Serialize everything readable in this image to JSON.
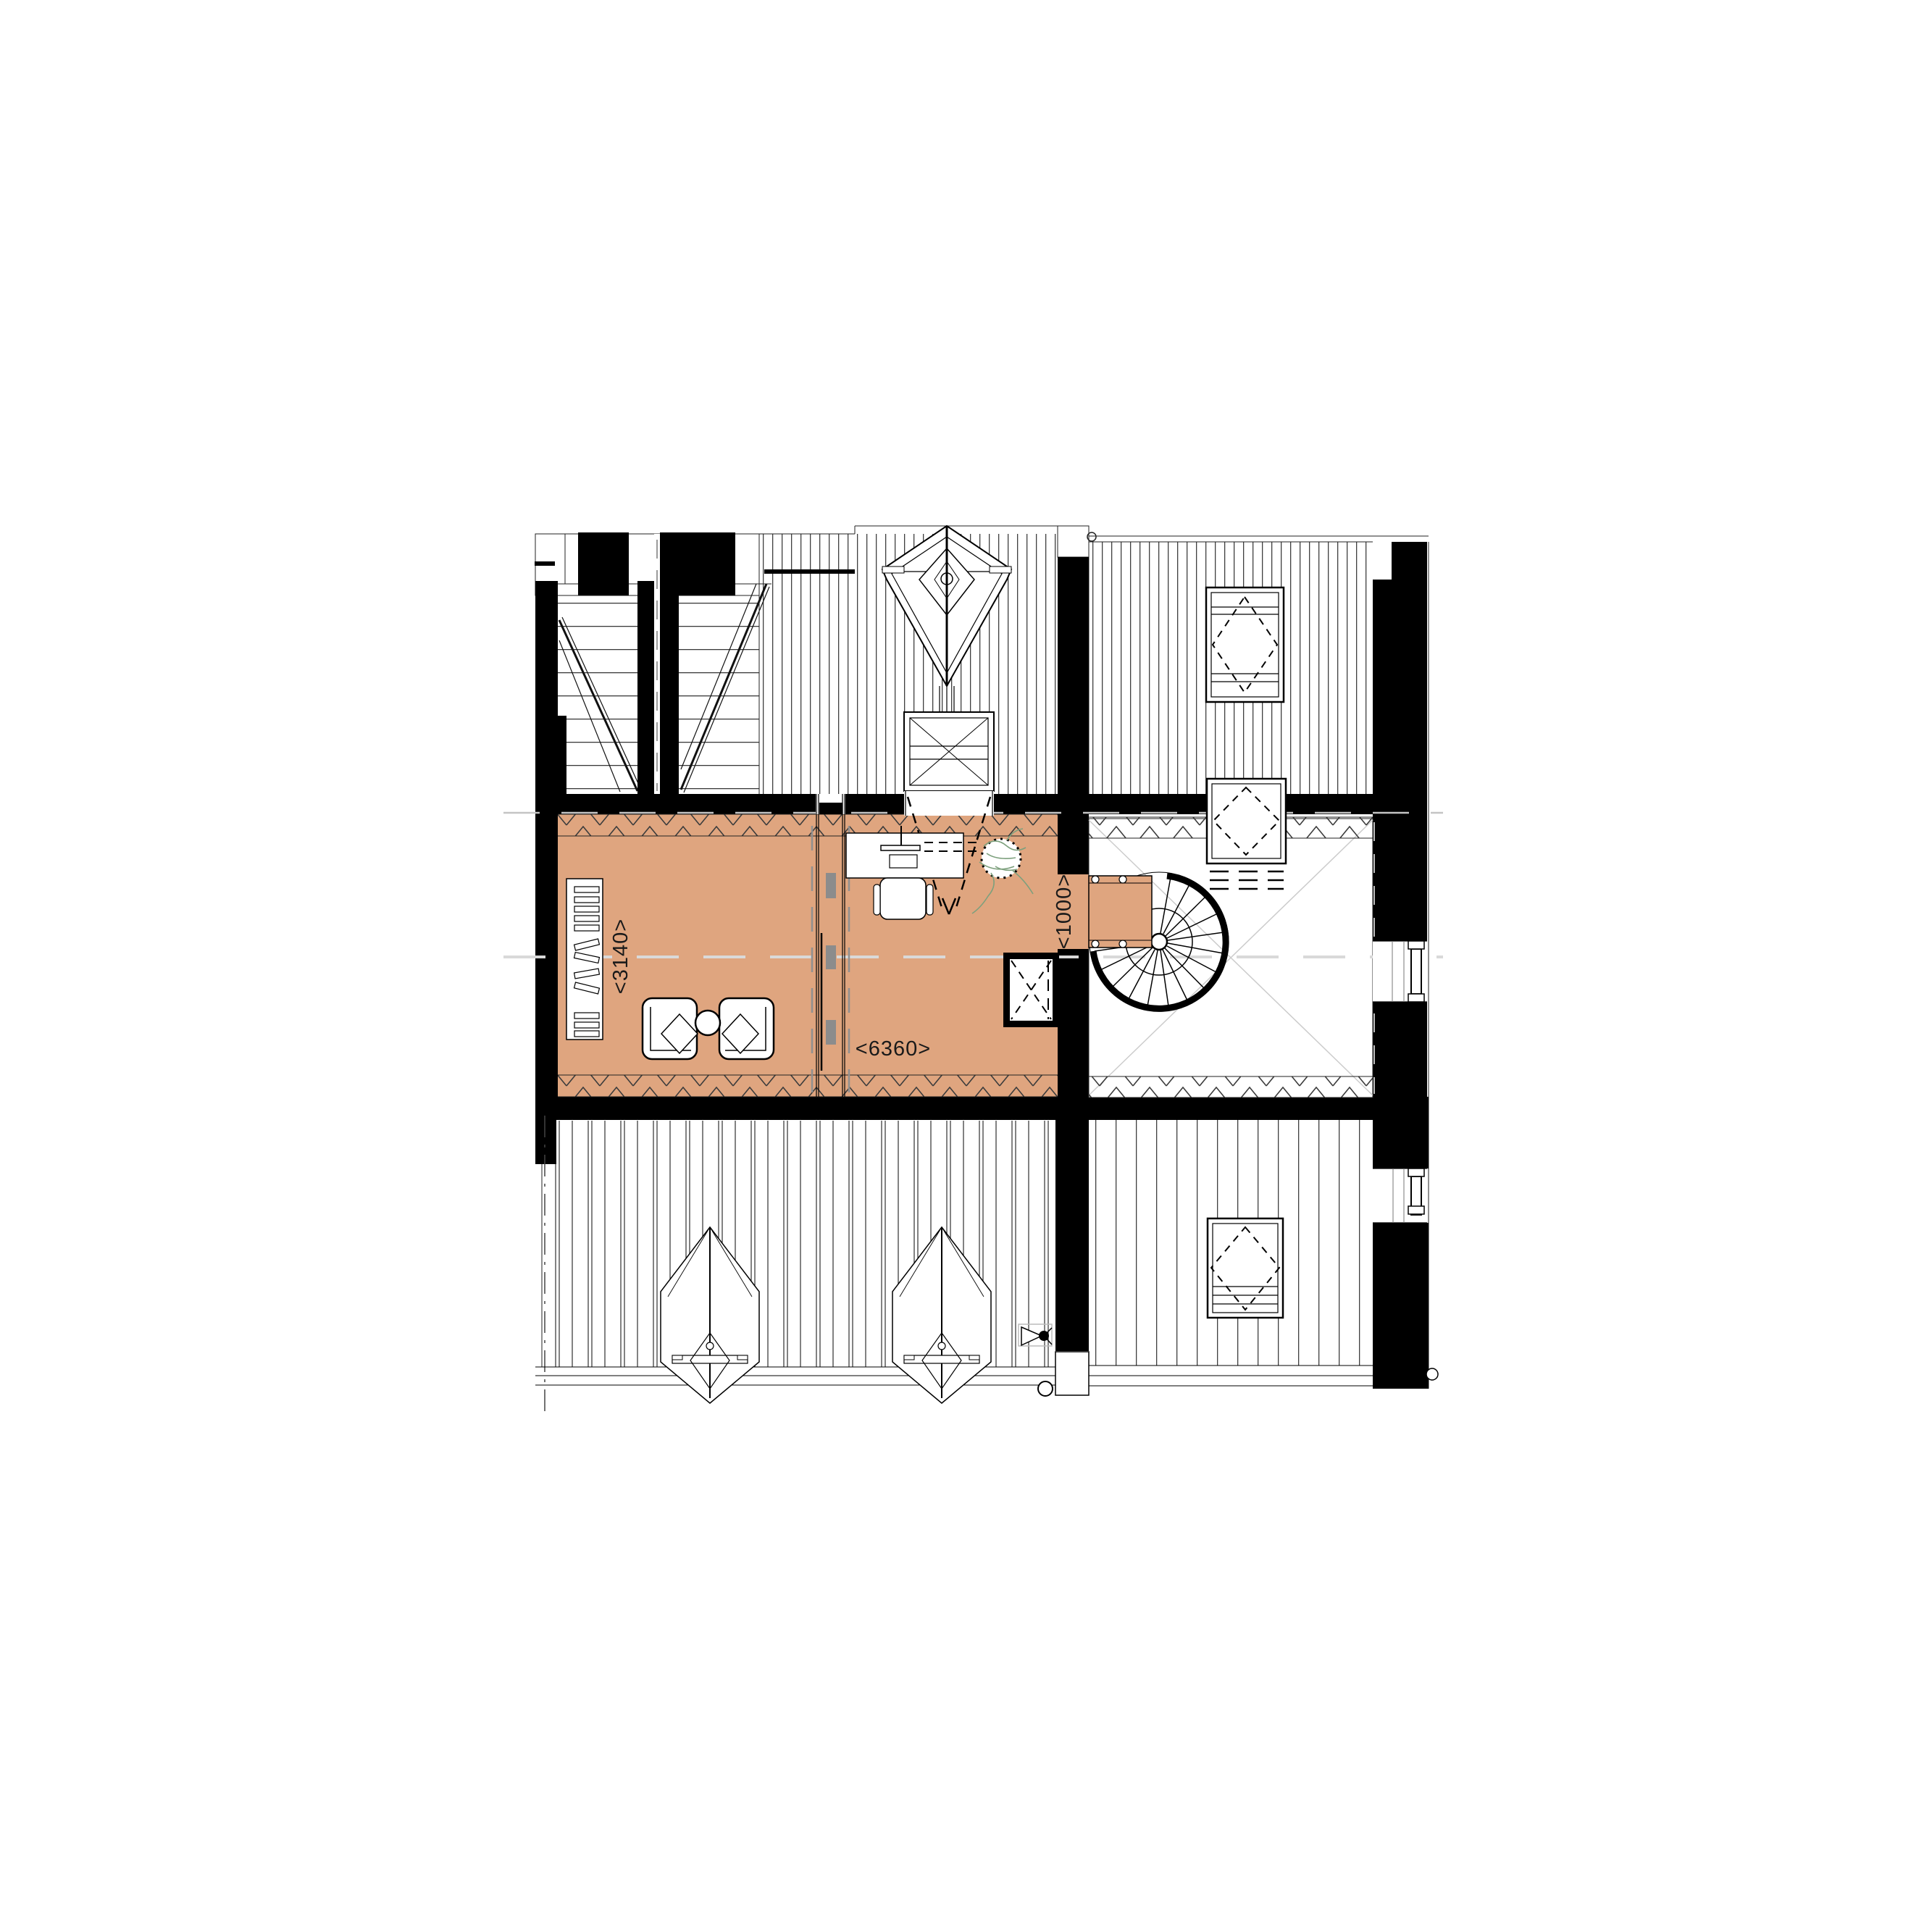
{
  "document": {
    "type": "architectural-floor-plan",
    "view": "attic-storey-plan",
    "page_background": "#ffffff"
  },
  "palette": {
    "floor_highlight": "#dfa57f",
    "walls": "#000000",
    "hatch_lines": "#1c1c1c",
    "zigzag_insulation": "#3c3c3c",
    "centerline_gray": "#d9d9d9",
    "door_leaf_gray": "#8c8c8c",
    "plant_green": "#7da07d"
  },
  "dimensions": {
    "living_width_label": "<3140>",
    "room_length_label": "<6360>",
    "corridor_width_label": "<1000>"
  }
}
